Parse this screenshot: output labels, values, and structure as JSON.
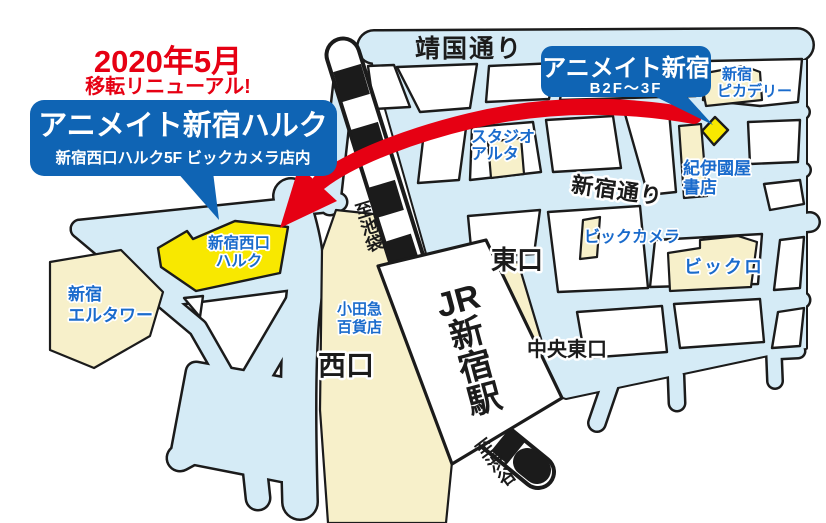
{
  "colors": {
    "street_blue": "#d5ebf6",
    "outline_black": "#1b1b1b",
    "building_cream": "#f7f0ca",
    "highlight_yellow": "#f8e800",
    "bubble_blue": "#0f64b4",
    "label_blue": "#1a6bcc",
    "accent_red": "#e60013"
  },
  "announcement": {
    "line1": "2020年5月",
    "line2": "移転リニューアル!"
  },
  "new_store_bubble": {
    "title": "アニメイト新宿ハルク",
    "subtitle": "新宿西口ハルク5F ビックカメラ店内"
  },
  "old_store_bubble": {
    "title": "アニメイト新宿",
    "floors": "B2F〜3F"
  },
  "streets": {
    "yasukuni_dori": "靖国通り",
    "shinjuku_dori": "新宿通り"
  },
  "station": {
    "name": "JR新宿駅",
    "to_ikebukuro": "至池袋",
    "to_shibuya": "至渋谷"
  },
  "exits": {
    "east": "東口",
    "west": "西口",
    "central_east": "中央東口"
  },
  "buildings": {
    "shinjuku_piccadilly": {
      "line1": "新宿",
      "line2": "ピカデリー"
    },
    "studio_alta": {
      "line1": "スタジオ",
      "line2": "アルタ"
    },
    "kinokuniya": {
      "line1": "紀伊國屋",
      "line2": "書店"
    },
    "bic_camera": {
      "name": "ビックカメラ"
    },
    "bicqlo": {
      "name": "ビックロ"
    },
    "shinjuku_nishiguchi_halc": {
      "line1": "新宿西口",
      "line2": "ハルク"
    },
    "shinjuku_l_tower": {
      "line1": "新宿",
      "line2": "エルタワー"
    },
    "odakyu_dept": {
      "line1": "小田急",
      "line2": "百貨店"
    }
  }
}
